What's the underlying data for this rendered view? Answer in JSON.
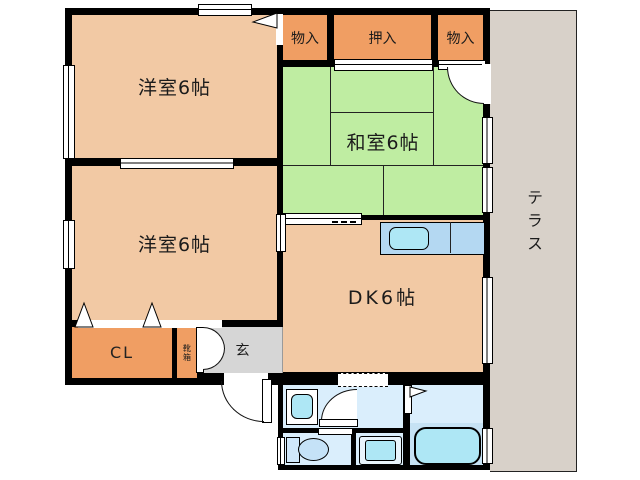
{
  "plan": {
    "type": "floor-plan",
    "labels": {
      "bedroom1": "洋室6帖",
      "bedroom2": "洋室6帖",
      "tatami_room": "和室6帖",
      "dining_kitchen": "DK6帖",
      "terrace": "テラス",
      "storage_left": "物入",
      "oshiire": "押入",
      "storage_right": "物入",
      "closet": "CL",
      "shoe_box": "靴箱",
      "entrance": "玄"
    },
    "colors": {
      "wall": "#000000",
      "western_room_floor": "#f2c9a4",
      "storage_fill": "#f09e63",
      "tatami_fill": "#bfeda2",
      "entrance_floor": "#d6d6d6",
      "terrace_fill": "#d8d1c9",
      "kitchen_counter": "#b4d8f2",
      "wet_area_floor": "#daeefc",
      "fixture_fill": "#aee7f5",
      "bath_floor": "#c6e2f4"
    }
  }
}
